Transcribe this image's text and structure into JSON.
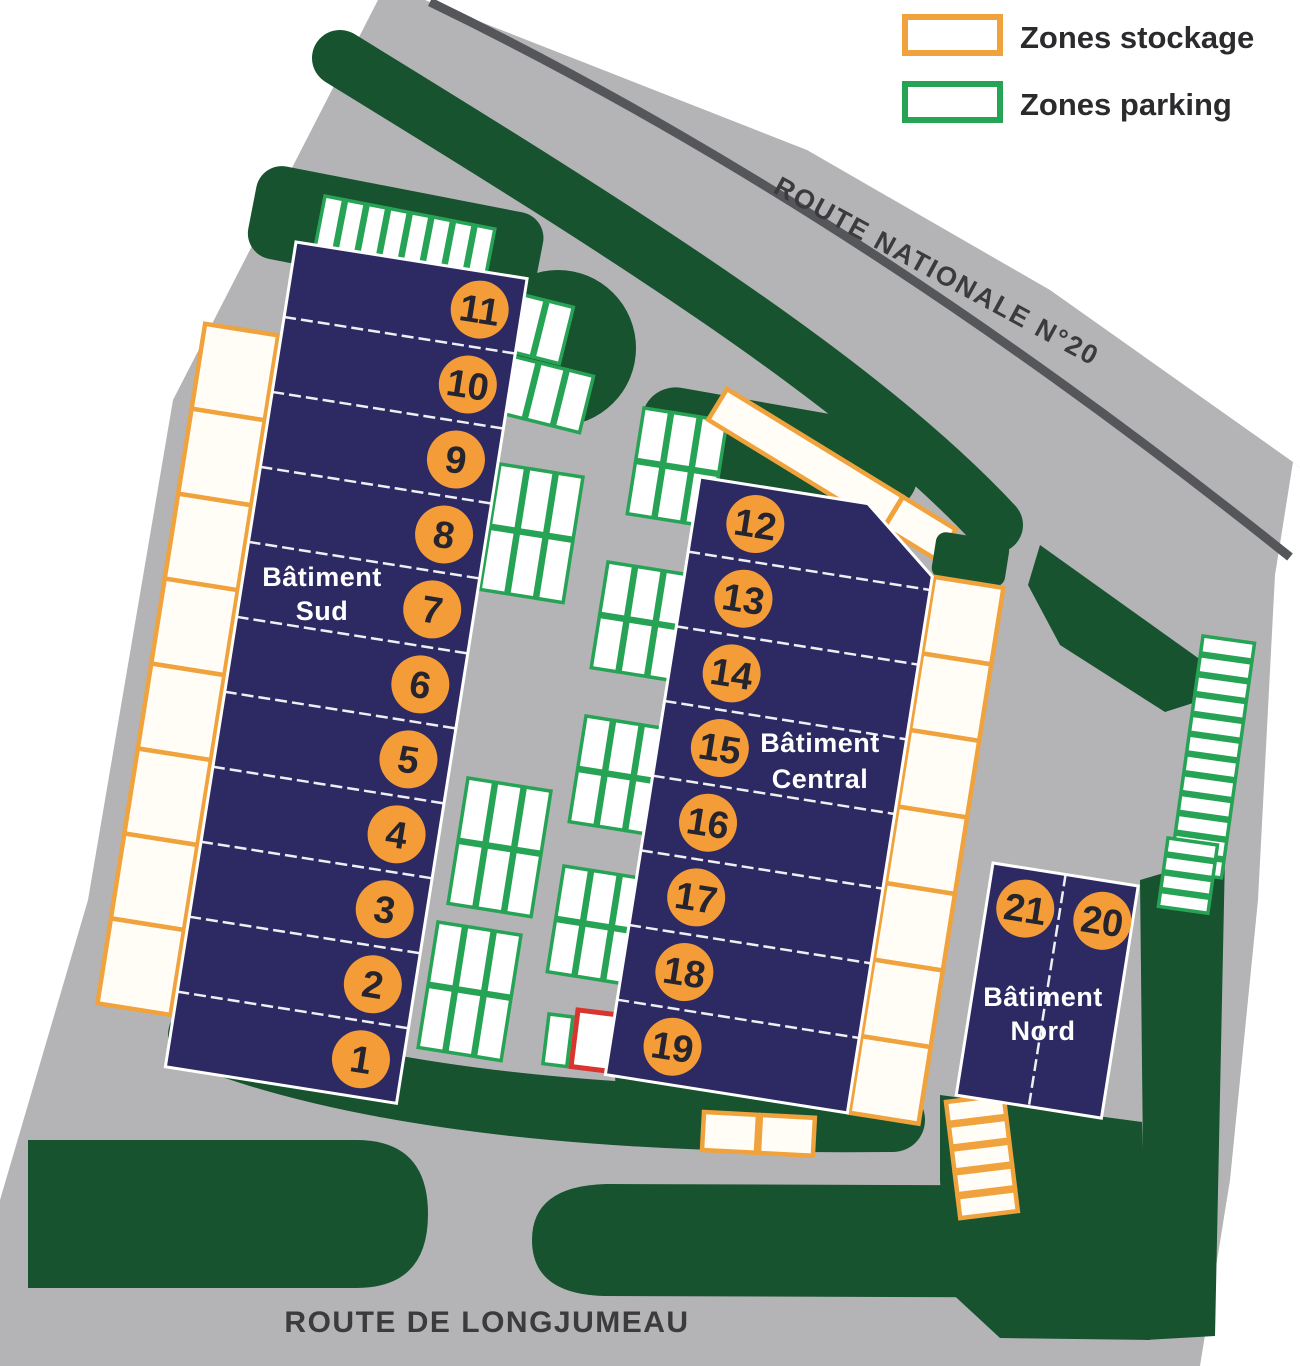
{
  "legend": {
    "items": [
      {
        "id": "stockage",
        "label": "Zones stockage"
      },
      {
        "id": "parking",
        "label": "Zones parking"
      }
    ]
  },
  "roads": {
    "top": "ROUTE NATIONALE N°20",
    "bottom": "ROUTE DE LONGJUMEAU"
  },
  "buildings": [
    {
      "id": "sud",
      "label_lines": [
        "Bâtiment",
        "Sud"
      ],
      "units": [
        11,
        10,
        9,
        8,
        7,
        6,
        5,
        4,
        3,
        2,
        1
      ]
    },
    {
      "id": "central",
      "label_lines": [
        "Bâtiment",
        "Central"
      ],
      "units": [
        12,
        13,
        14,
        15,
        16,
        17,
        18,
        19
      ]
    },
    {
      "id": "nord",
      "label_lines": [
        "Bâtiment",
        "Nord"
      ],
      "units": [
        21,
        20
      ]
    }
  ],
  "colors": {
    "site": "#b4b4b7",
    "landscape": "#16532e",
    "building": "#2c2963",
    "storage_border": "#f0a23c",
    "parking_border": "#27a355",
    "badge": "#f39c38",
    "red_zone": "#d8352f",
    "road_line": "#55565a",
    "text_dark": "#3b3b3d"
  }
}
